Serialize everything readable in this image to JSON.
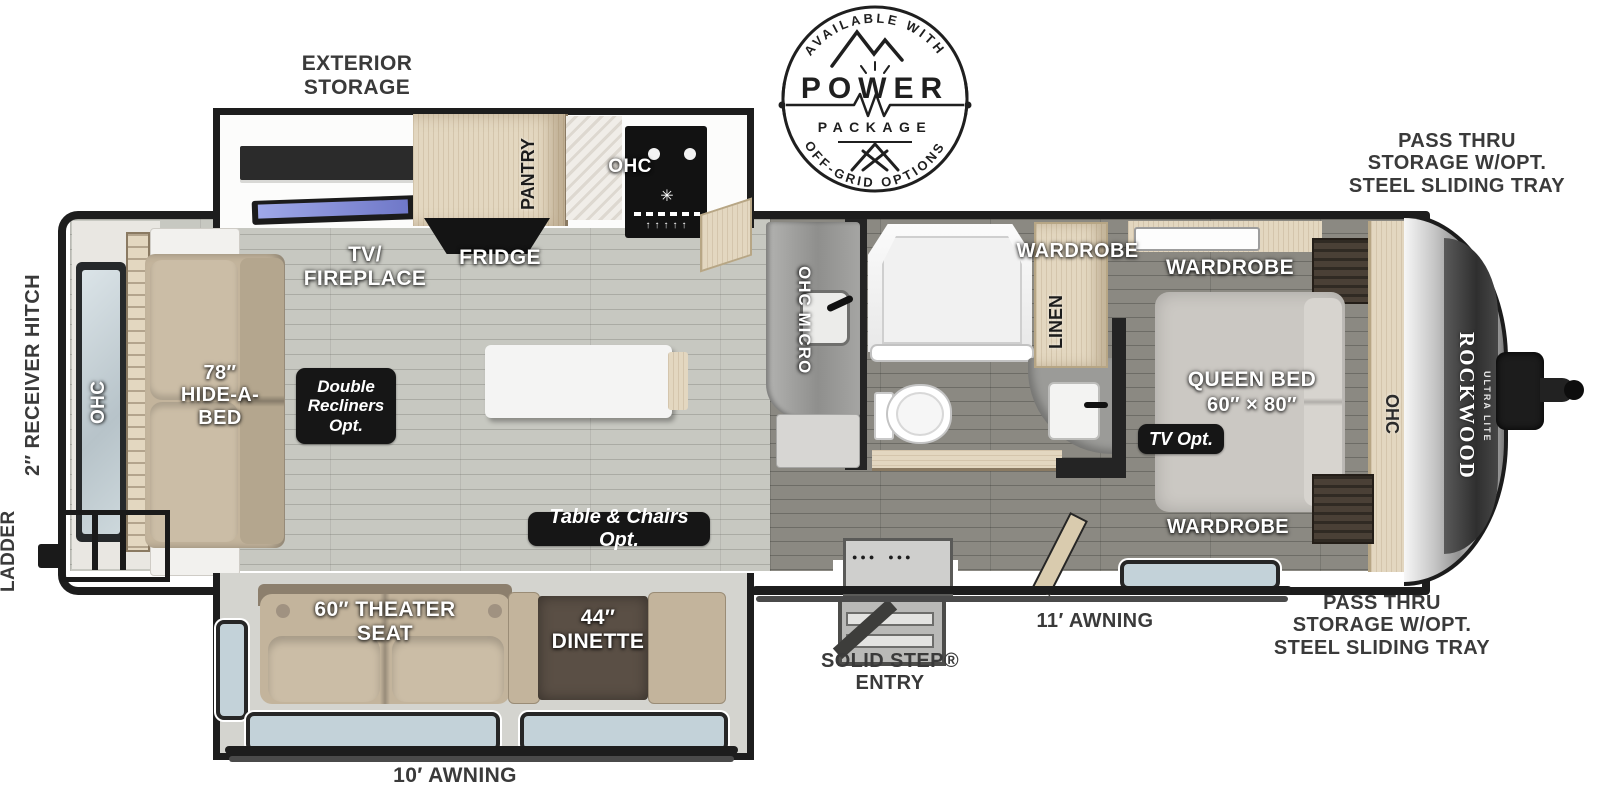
{
  "ext": {
    "exterior_storage": "EXTERIOR\nSTORAGE",
    "pass_thru_top": "PASS THRU\nSTORAGE W/OPT.\nSTEEL SLIDING TRAY",
    "pass_thru_bottom": "PASS THRU\nSTORAGE W/OPT.\nSTEEL SLIDING TRAY",
    "receiver_hitch": "2″ RECEIVER HITCH",
    "ladder": "LADDER",
    "awning_11": "11′ AWNING",
    "awning_10": "10′ AWNING",
    "solid_step": "SOLID STEP®\nENTRY"
  },
  "int": {
    "ohc_rear": "OHC",
    "hide_a_bed": "78″\nHIDE-A-\nBED",
    "tv_fireplace": "TV/\nFIREPLACE",
    "fridge": "FRIDGE",
    "pantry": "PANTRY",
    "ohc_kitchen": "OHC",
    "ohc_micro": "OHC  MICRO",
    "wardrobe_bath": "WARDROBE",
    "linen": "LINEN",
    "wardrobe_bed": "WARDROBE",
    "queen_bed1": "QUEEN BED",
    "queen_bed2": "60″ × 80″",
    "ohc_bed": "OHC",
    "wardrobe_front": "WARDROBE",
    "theater_seat": "60″ THEATER\nSEAT",
    "dinette": "44″\nDINETTE"
  },
  "opt": {
    "double_recliners": "Double\nRecliners\nOpt.",
    "table_chairs": "Table & Chairs Opt.",
    "tv_opt": "TV Opt."
  },
  "brand": {
    "name": "ROCKWOOD",
    "sub": "ULTRA LITE"
  },
  "badge": {
    "available_with": "AVAILABLE WITH",
    "power": "POWER",
    "package": "PACKAGE",
    "off_grid": "OFF-GRID OPTIONS"
  },
  "colors": {
    "wall": "#1d1d1d",
    "floor_light": "#c7c8c1",
    "floor_dark": "#8b8982",
    "wood": "#e3d7c0",
    "upholstery": "#c3b49c",
    "badge_bg": "#161616",
    "label_dark": "#3a3a3a"
  }
}
